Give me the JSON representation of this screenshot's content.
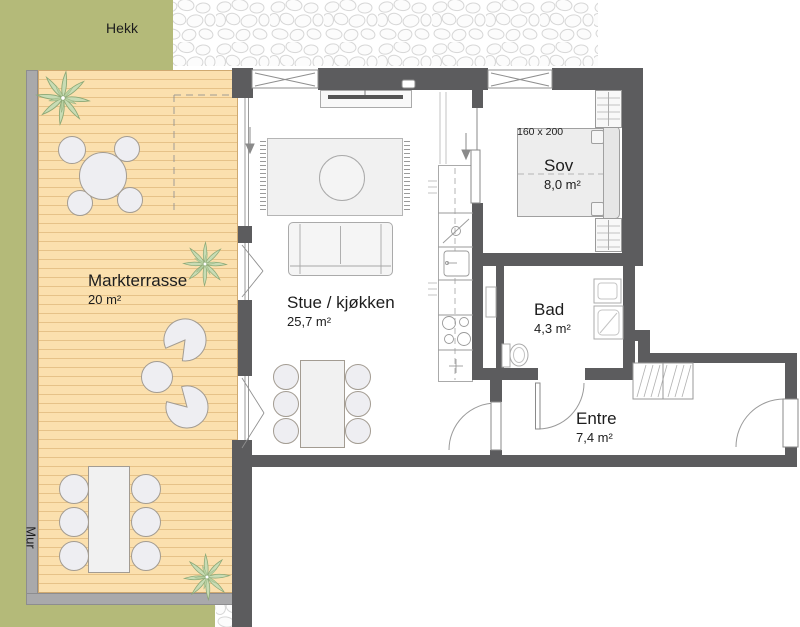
{
  "colors": {
    "wallDark": "#5c5c5e",
    "wallLight": "#a9a9ab",
    "green": "#b4ba79",
    "deck": "#fbe0ae",
    "deckStripe": "#e6c288",
    "furnitureFill": "#eeeef2",
    "lineGray": "#9a9a9a",
    "textColor": "#1d1d1d"
  },
  "plan": {
    "outdoor": {
      "hedge_label": "Hekk",
      "retaining_wall_label": "Mur"
    },
    "rooms": [
      {
        "id": "terrace",
        "name": "Markterrasse",
        "area": "20 m²"
      },
      {
        "id": "living_kitchen",
        "name": "Stue / kjøkken",
        "area": "25,7 m²"
      },
      {
        "id": "bedroom",
        "name": "Sov",
        "area": "8,0 m²",
        "bed_size": "160 x 200"
      },
      {
        "id": "bathroom",
        "name": "Bad",
        "area": "4,3 m²"
      },
      {
        "id": "entry",
        "name": "Entre",
        "area": "7,4 m²"
      }
    ]
  }
}
